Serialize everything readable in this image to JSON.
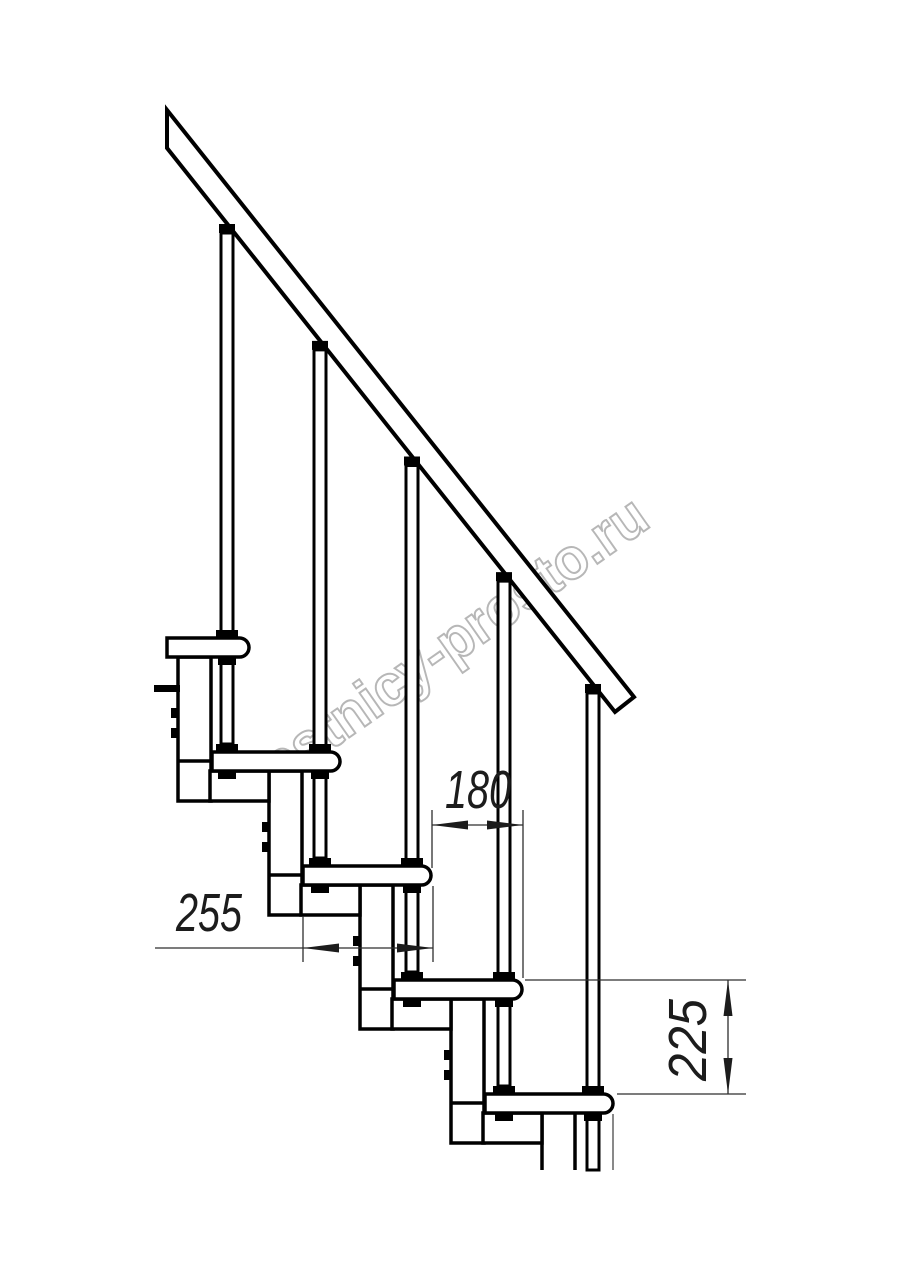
{
  "drawing": {
    "title": "modular-staircase-side-view-technical-drawing",
    "dimensions": {
      "step_run": {
        "value": "180",
        "meaning": "horizontal distance between step noses"
      },
      "tread_depth": {
        "value": "255",
        "meaning": "depth of one tread"
      },
      "riser_height": {
        "value": "225",
        "meaning": "vertical rise between treads"
      }
    },
    "watermark": {
      "text": "lestnicy-prosto.ru",
      "color": "#ababab"
    },
    "counts": {
      "treads": 5,
      "balusters": 5,
      "support_columns": 5
    },
    "colors": {
      "line": "#000000",
      "dimension_line": "#2e2e2e",
      "background": "#ffffff"
    }
  }
}
